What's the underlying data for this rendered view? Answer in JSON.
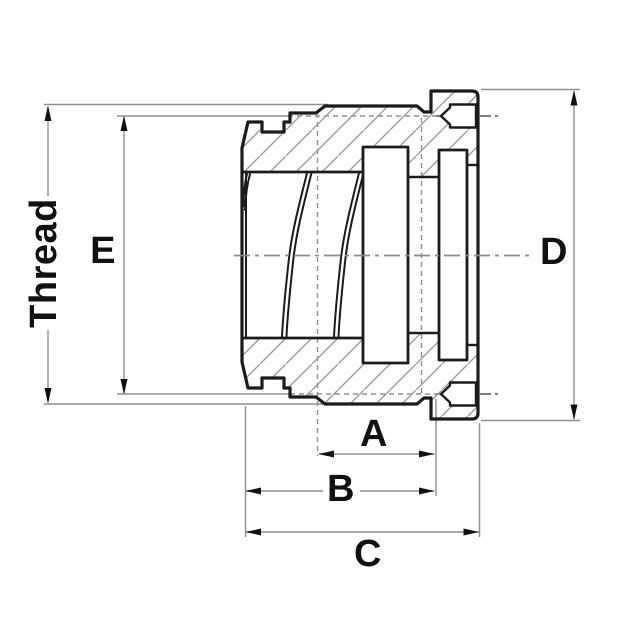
{
  "drawing": {
    "kind": "technical-cross-section",
    "labels": {
      "thread": "Thread",
      "e": "E",
      "d": "D",
      "a": "A",
      "b": "B",
      "c": "C"
    },
    "colors": {
      "background": "#ffffff",
      "outline": "#1b1b1b",
      "dimension_lines": "#8f8f8f",
      "hatch_lines": "#9d9d9d",
      "centerline": "#8a8a8a",
      "label_text": "#111111",
      "arrowheads": "#111111"
    }
  }
}
